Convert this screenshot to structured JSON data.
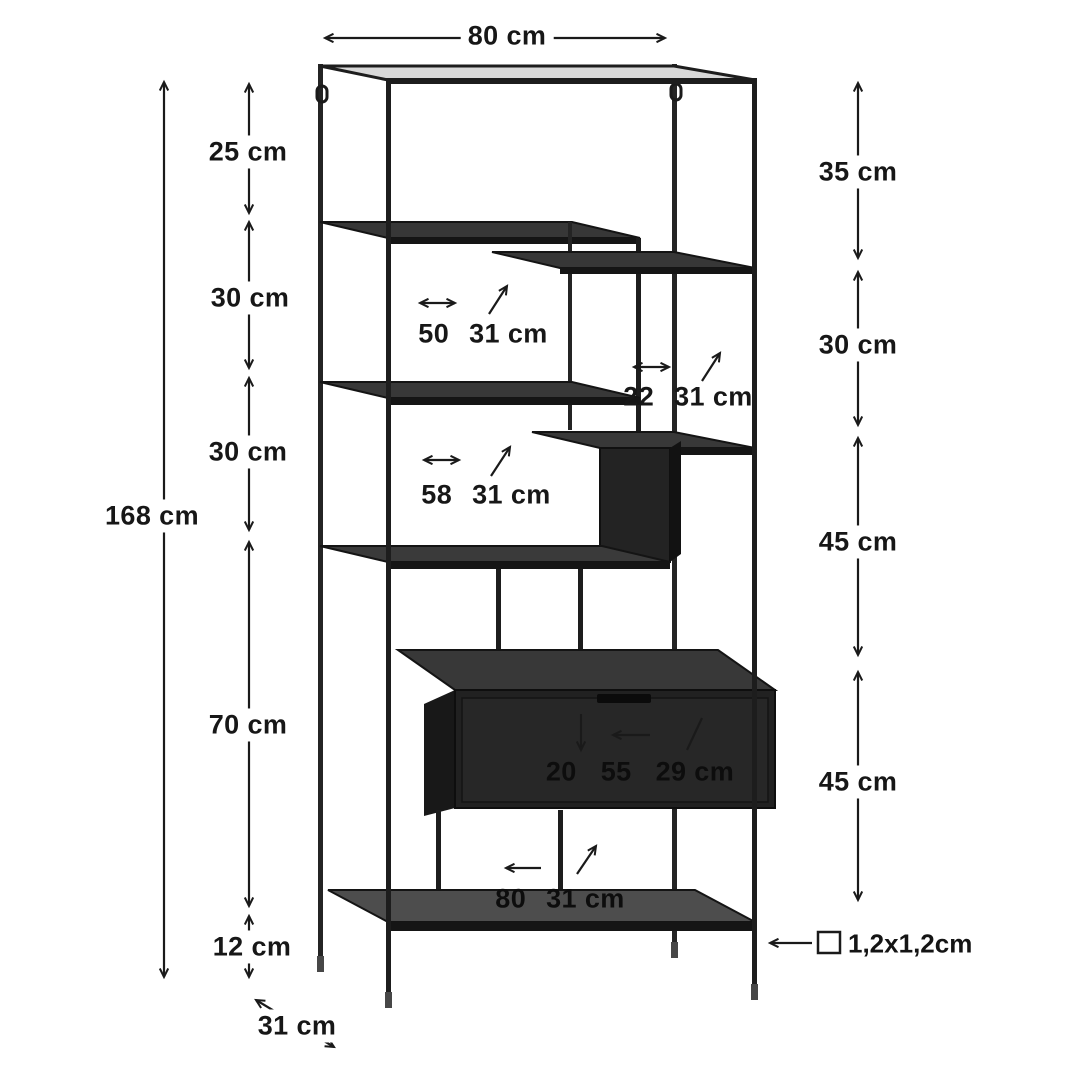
{
  "page": {
    "background": "#ffffff",
    "type": "furniture-dimension-diagram"
  },
  "product": {
    "name": "metal shelving unit with drawer",
    "finish": "black"
  },
  "colors": {
    "annotation": "#1a1a1a",
    "frame": "#1d1d1d",
    "shelf_top": "#3a3a3a",
    "drawer_front": "#222222",
    "bottom_shelf_top": "#4d4d4d",
    "top_rail_highlight": "#d8d8d8"
  },
  "annotations": {
    "top_width": "80 cm",
    "total_height": "168 cm",
    "left_segments": [
      "25 cm",
      "30 cm",
      "30 cm",
      "70 cm",
      "12 cm"
    ],
    "right_segments": [
      "35 cm",
      "30 cm",
      "45 cm",
      "45 cm"
    ],
    "base_depth": "31 cm",
    "tube_profile": "1,2x1,2cm",
    "upper_shelf": {
      "width": "50",
      "depth": "31 cm"
    },
    "step_shelf": {
      "width": "22",
      "depth": "31 cm"
    },
    "middle_shelf": {
      "width": "58",
      "depth": "31 cm"
    },
    "drawer": {
      "height": "20",
      "width": "55",
      "depth": "29 cm"
    },
    "bottom_shelf": {
      "width": "80",
      "depth": "31 cm"
    }
  }
}
